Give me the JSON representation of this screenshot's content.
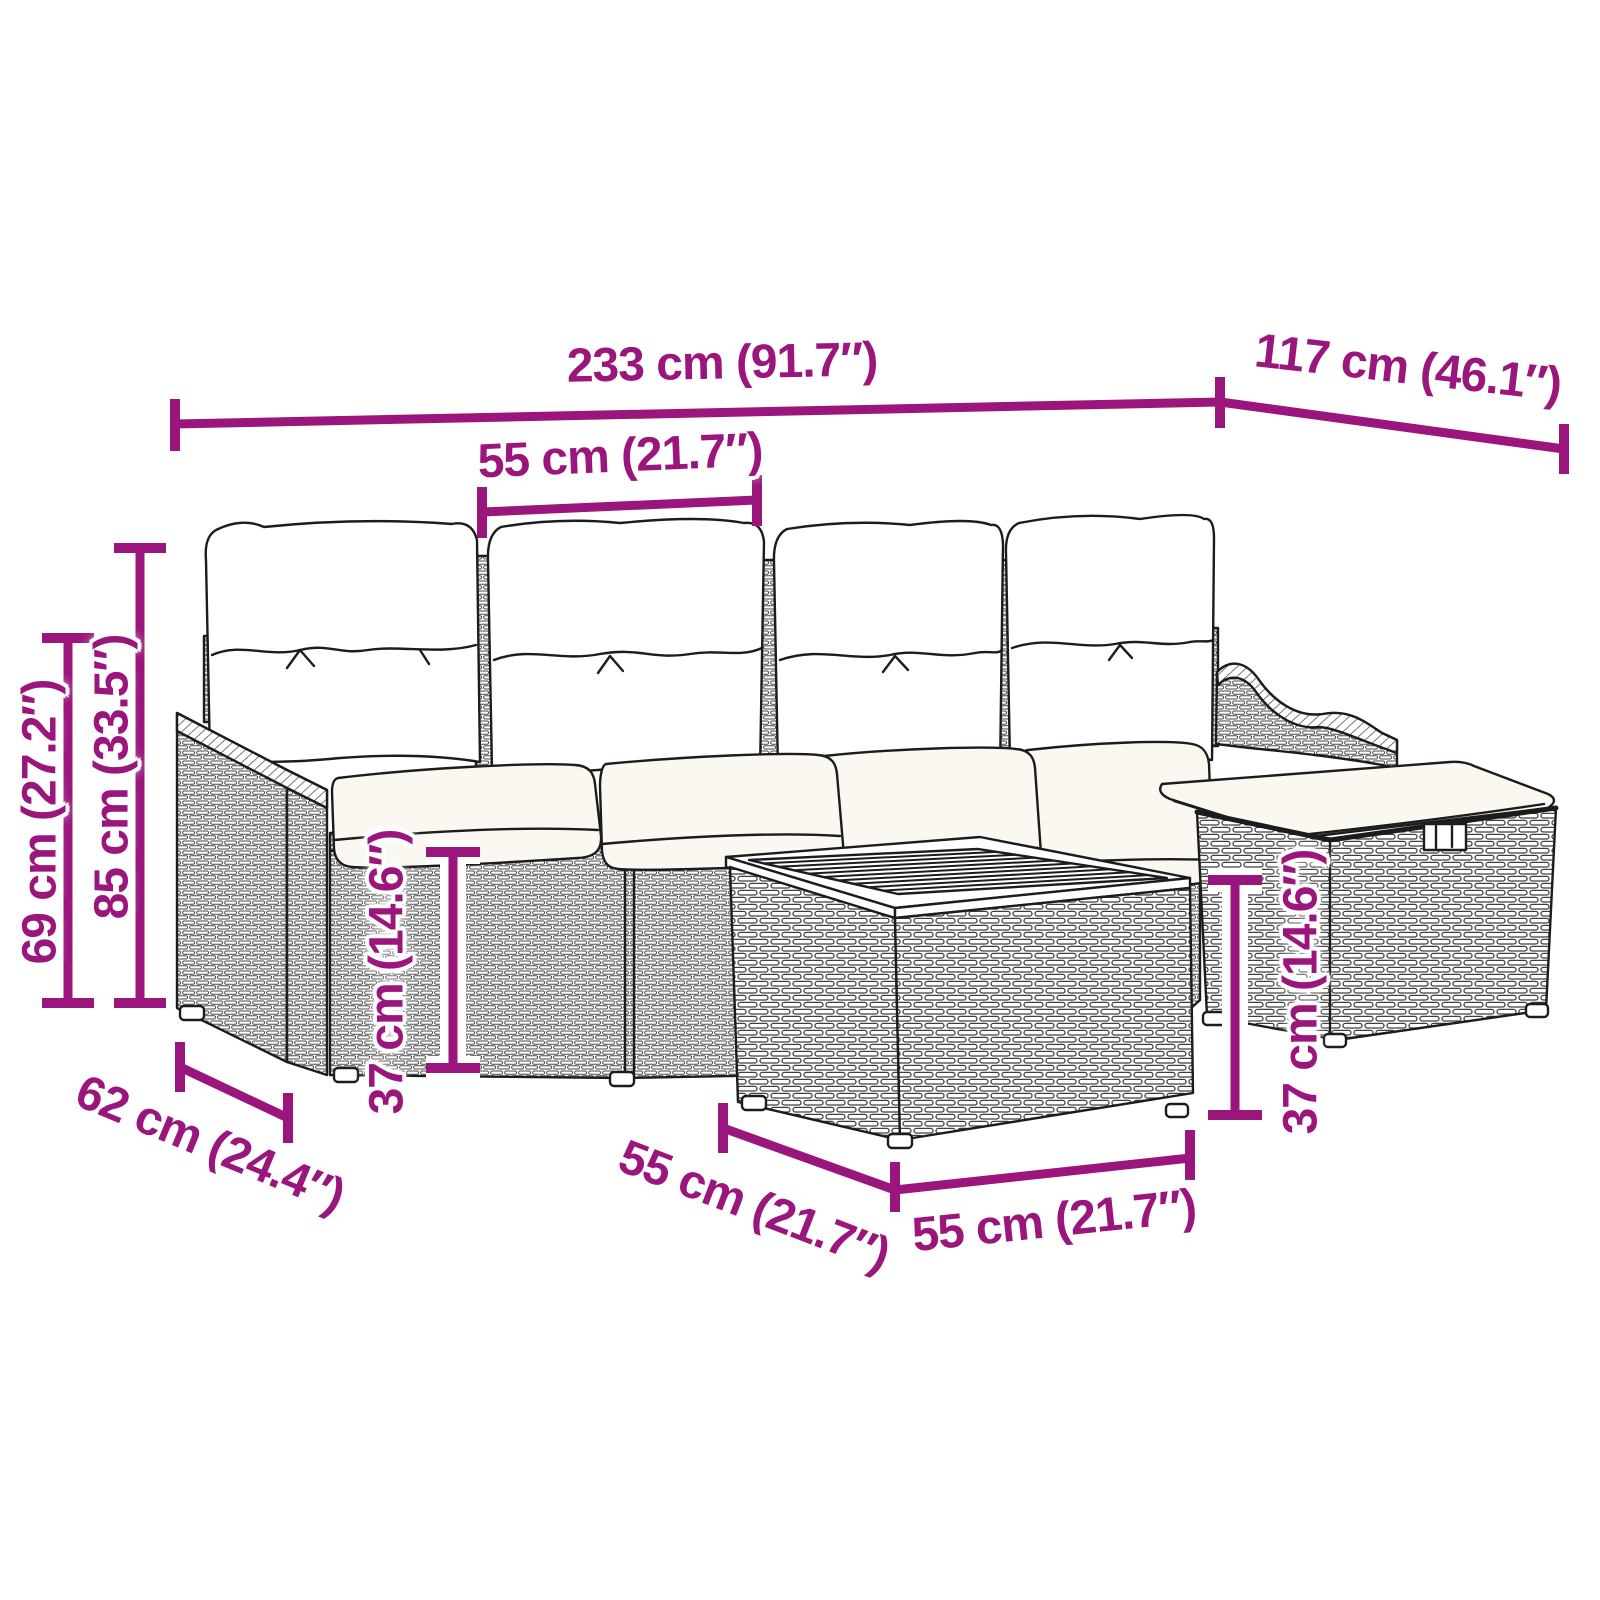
{
  "diagram": {
    "accent": "#9A157C",
    "outline_color": "#1C1C1C",
    "cushion_color": "#FAF8F1",
    "background": "#FFFFFF",
    "product": "garden-sofa-set-dimension-diagram",
    "dimensions": {
      "total_width": "233 cm (91.7″)",
      "total_depth": "117 cm (46.1″)",
      "seat_width": "55 cm (21.7″)",
      "back_height": "69 cm (27.2″)",
      "total_height": "85 cm (33.5″)",
      "seat_height_left": "37 cm (14.6″)",
      "seat_height_right": "37 cm (14.6″)",
      "armrest_depth": "62 cm (24.4″)",
      "table_depth": "55 cm (21.7″)",
      "table_width": "55 cm (21.7″)"
    }
  }
}
